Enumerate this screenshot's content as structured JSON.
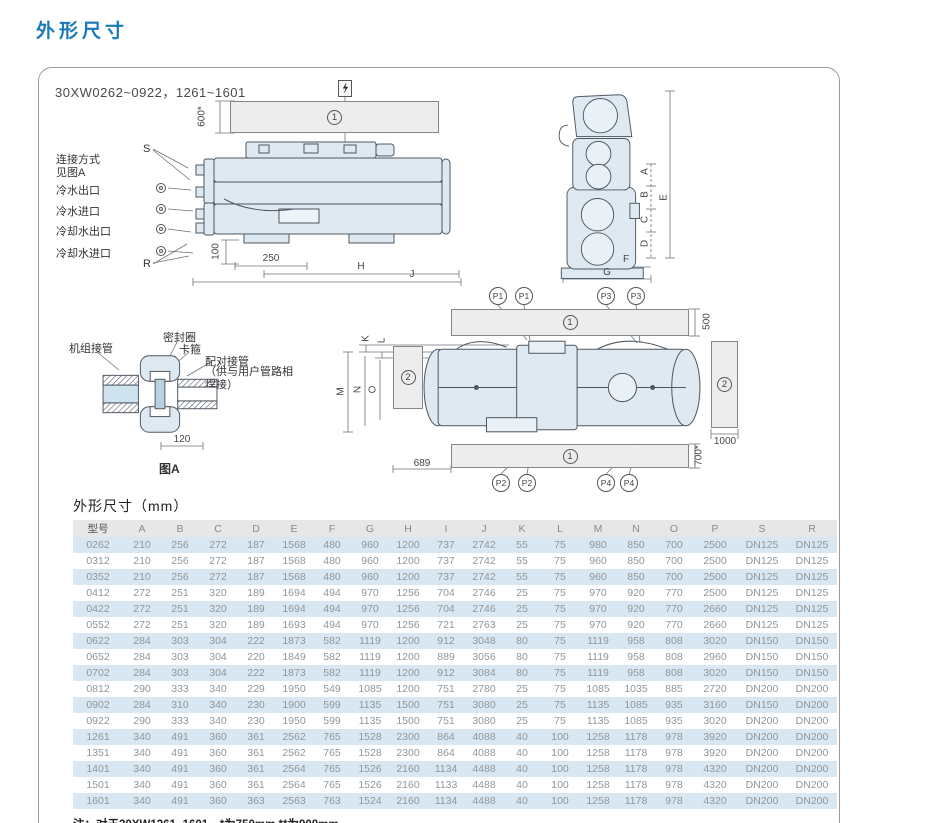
{
  "page": {
    "title": "外形尺寸"
  },
  "panel": {
    "model_range": "30XW0262~0922，1261~1601"
  },
  "zones": {
    "band": "1",
    "block": "2"
  },
  "side_view": {
    "labels": {
      "s": "S",
      "r": "R",
      "connection_line1": "连接方式",
      "connection_line2": "见图A",
      "ports": [
        "冷水出口",
        "冷水进口",
        "冷却水出口",
        "冷却水进口"
      ]
    },
    "dims": {
      "top_clearance": "600*",
      "foot_height": "100",
      "foot_offset": "250",
      "h": "H",
      "j": "J"
    }
  },
  "end_view": {
    "dims": {
      "a": "A",
      "b": "B",
      "c": "C",
      "d": "D",
      "e": "E",
      "f": "F",
      "g": "G"
    }
  },
  "plan_view": {
    "p_labels": {
      "p1": "P1",
      "p2": "P2",
      "p3": "P3",
      "p4": "P4"
    },
    "dims": {
      "top": "500",
      "right": "1000",
      "bottom": "700*",
      "left_offset": "689",
      "k": "K",
      "l": "L",
      "m": "M",
      "n": "N",
      "o": "O"
    }
  },
  "fig_a": {
    "labels": {
      "unit_pipe": "机组接管",
      "seal_ring": "密封圈",
      "clamp": "卡箍",
      "mating_pipe": "配对接管",
      "mating_note": "（供与用户管路相焊接）"
    },
    "dim": "120",
    "caption": "图A"
  },
  "table": {
    "title": "外形尺寸（mm）",
    "columns": [
      "型号",
      "A",
      "B",
      "C",
      "D",
      "E",
      "F",
      "G",
      "H",
      "I",
      "J",
      "K",
      "L",
      "M",
      "N",
      "O",
      "P",
      "S",
      "R"
    ],
    "rows": [
      [
        "0262",
        "210",
        "256",
        "272",
        "187",
        "1568",
        "480",
        "960",
        "1200",
        "737",
        "2742",
        "55",
        "75",
        "980",
        "850",
        "700",
        "2500",
        "DN125",
        "DN125"
      ],
      [
        "0312",
        "210",
        "256",
        "272",
        "187",
        "1568",
        "480",
        "960",
        "1200",
        "737",
        "2742",
        "55",
        "75",
        "960",
        "850",
        "700",
        "2500",
        "DN125",
        "DN125"
      ],
      [
        "0352",
        "210",
        "256",
        "272",
        "187",
        "1568",
        "480",
        "960",
        "1200",
        "737",
        "2742",
        "55",
        "75",
        "960",
        "850",
        "700",
        "2500",
        "DN125",
        "DN125"
      ],
      [
        "0412",
        "272",
        "251",
        "320",
        "189",
        "1694",
        "494",
        "970",
        "1256",
        "704",
        "2746",
        "25",
        "75",
        "970",
        "920",
        "770",
        "2500",
        "DN125",
        "DN125"
      ],
      [
        "0422",
        "272",
        "251",
        "320",
        "189",
        "1694",
        "494",
        "970",
        "1256",
        "704",
        "2746",
        "25",
        "75",
        "970",
        "920",
        "770",
        "2660",
        "DN125",
        "DN125"
      ],
      [
        "0552",
        "272",
        "251",
        "320",
        "189",
        "1693",
        "494",
        "970",
        "1256",
        "721",
        "2763",
        "25",
        "75",
        "970",
        "920",
        "770",
        "2660",
        "DN125",
        "DN125"
      ],
      [
        "0622",
        "284",
        "303",
        "304",
        "222",
        "1873",
        "582",
        "1119",
        "1200",
        "912",
        "3048",
        "80",
        "75",
        "1119",
        "958",
        "808",
        "3020",
        "DN150",
        "DN150"
      ],
      [
        "0652",
        "284",
        "303",
        "304",
        "220",
        "1849",
        "582",
        "1119",
        "1200",
        "889",
        "3056",
        "80",
        "75",
        "1119",
        "958",
        "808",
        "2960",
        "DN150",
        "DN150"
      ],
      [
        "0702",
        "284",
        "303",
        "304",
        "222",
        "1873",
        "582",
        "1119",
        "1200",
        "912",
        "3084",
        "80",
        "75",
        "1119",
        "958",
        "808",
        "3020",
        "DN150",
        "DN150"
      ],
      [
        "0812",
        "290",
        "333",
        "340",
        "229",
        "1950",
        "549",
        "1085",
        "1200",
        "751",
        "2780",
        "25",
        "75",
        "1085",
        "1035",
        "885",
        "2720",
        "DN200",
        "DN200"
      ],
      [
        "0902",
        "284",
        "310",
        "340",
        "230",
        "1900",
        "599",
        "1135",
        "1500",
        "751",
        "3080",
        "25",
        "75",
        "1135",
        "1085",
        "935",
        "3160",
        "DN150",
        "DN200"
      ],
      [
        "0922",
        "290",
        "333",
        "340",
        "230",
        "1950",
        "599",
        "1135",
        "1500",
        "751",
        "3080",
        "25",
        "75",
        "1135",
        "1085",
        "935",
        "3020",
        "DN200",
        "DN200"
      ],
      [
        "1261",
        "340",
        "491",
        "360",
        "361",
        "2562",
        "765",
        "1528",
        "2300",
        "864",
        "4088",
        "40",
        "100",
        "1258",
        "1178",
        "978",
        "3920",
        "DN200",
        "DN200"
      ],
      [
        "1351",
        "340",
        "491",
        "360",
        "361",
        "2562",
        "765",
        "1528",
        "2300",
        "864",
        "4088",
        "40",
        "100",
        "1258",
        "1178",
        "978",
        "3920",
        "DN200",
        "DN200"
      ],
      [
        "1401",
        "340",
        "491",
        "360",
        "361",
        "2564",
        "765",
        "1526",
        "2160",
        "1134",
        "4488",
        "40",
        "100",
        "1258",
        "1178",
        "978",
        "4320",
        "DN200",
        "DN200"
      ],
      [
        "1501",
        "340",
        "491",
        "360",
        "361",
        "2564",
        "765",
        "1526",
        "2160",
        "1133",
        "4488",
        "40",
        "100",
        "1258",
        "1178",
        "978",
        "4320",
        "DN200",
        "DN200"
      ],
      [
        "1601",
        "340",
        "491",
        "360",
        "363",
        "2563",
        "763",
        "1524",
        "2160",
        "1134",
        "4488",
        "40",
        "100",
        "1258",
        "1178",
        "978",
        "4320",
        "DN200",
        "DN200"
      ]
    ],
    "note": "注：对于30XW1261~1601，*为750mm,**为900mm。"
  }
}
